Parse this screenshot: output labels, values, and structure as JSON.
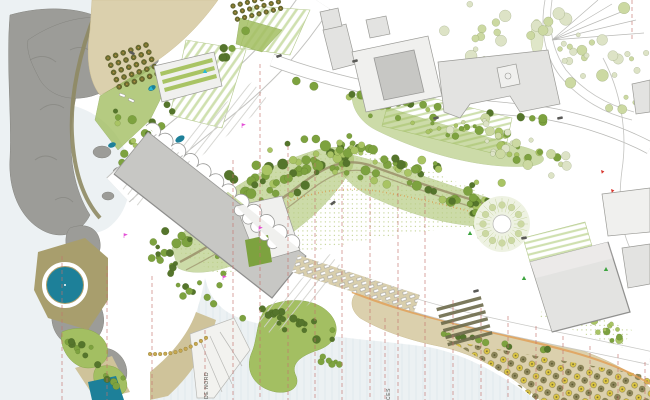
{
  "plan": {
    "annotations": {
      "promenade_label": "DE NORD",
      "access_label": "CES"
    }
  },
  "palette": {
    "sea": "#ecf1f3",
    "sea_line": "#dde6ea",
    "sand": "#dbd0ad",
    "sand_dark": "#cfc39a",
    "rock": "#9c9c98",
    "rock_shadow": "#84847f",
    "coast_path": "#8f8a63",
    "building_fill": "#e3e3e1",
    "building_stroke": "#9b9b97",
    "roof": "#c7c7c4",
    "tree_dark": "#55752c",
    "tree_mid": "#7da23f",
    "tree_light": "#a9c464",
    "tree_pale": "#ccd9a2",
    "tree_faint": "#dde3c6",
    "lawn": "#a3bf62",
    "hedge": "#cfe0af",
    "pool": "#1d8099",
    "pool_deck": "#a89e6d",
    "umbrella_yellow": "#dcc544",
    "umbrella_olive": "#8d875c",
    "section_line": "#c4726c",
    "contour_orange": "#e0a159",
    "path_olive": "#9a8f6a",
    "marker_magenta": "#e34fd6",
    "marker_cyan": "#29b9d6",
    "marker_green": "#3da43f",
    "marker_red": "#d8382f",
    "car": "#5a5a57"
  }
}
